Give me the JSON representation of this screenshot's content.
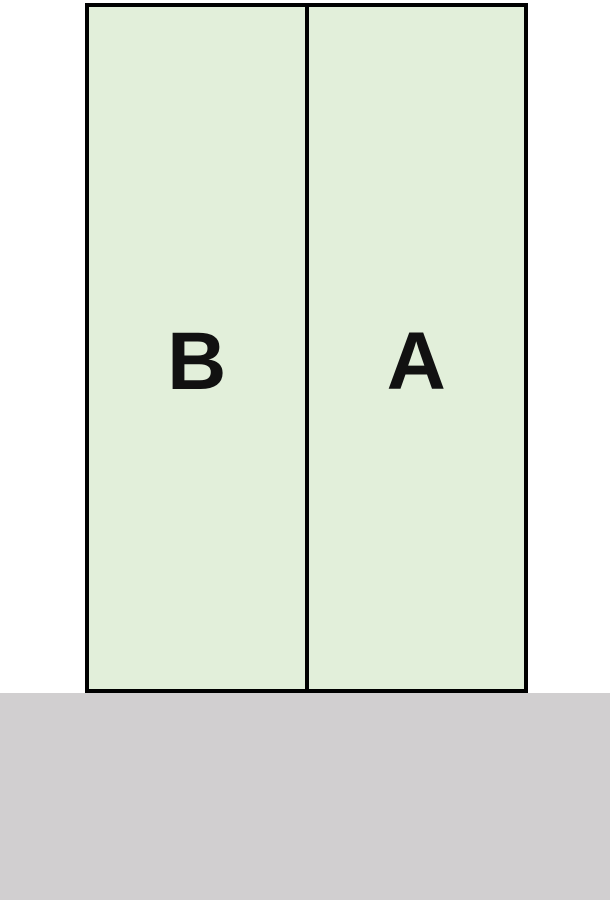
{
  "diagram": {
    "description": "Two attached vertical units on a ground strip",
    "units": [
      {
        "id": "unit-b",
        "label": "B"
      },
      {
        "id": "unit-a",
        "label": "A"
      }
    ],
    "colors": {
      "unit_fill": "#e2efda",
      "outline": "#000000",
      "ground": "#d1cfd0",
      "background": "#ffffff"
    }
  }
}
